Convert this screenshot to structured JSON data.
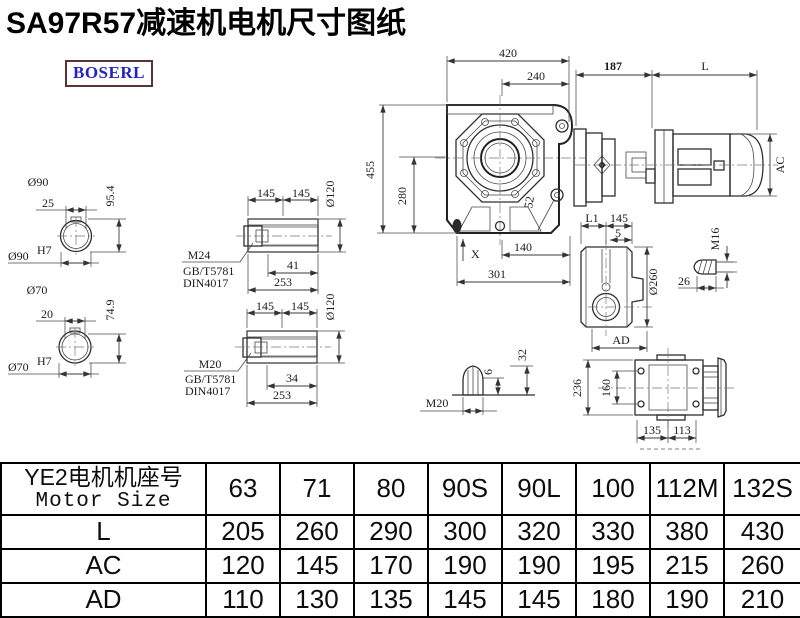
{
  "title": "SA97R57减速机电机尺寸图纸",
  "logo": {
    "text": "BOSERL"
  },
  "drawing": {
    "main_view": {
      "total_width": "420",
      "half_width": "240",
      "total_height": "455",
      "center_height": "280",
      "hole_offset": "52",
      "foot_mark": "X",
      "center_to_foot": "140",
      "base_length": "301"
    },
    "motor": {
      "flange_length": "187",
      "length": "L",
      "diameter": "AC"
    },
    "shaft_90": {
      "diameter": "Ø90",
      "keyway_width": "25",
      "height": "95.4",
      "bore": "Ø90",
      "bore_fit": "H7"
    },
    "shaft_70": {
      "diameter": "Ø70",
      "keyway_width": "20",
      "height": "74.9",
      "bore": "Ø70",
      "bore_fit": "H7"
    },
    "hollow_shaft_a": {
      "seg1": "145",
      "seg2": "145",
      "diameter": "Ø120",
      "thread_depth": "41",
      "length": "253",
      "screw": "M24",
      "standard1": "GB/T5781",
      "standard2": "DIN4017"
    },
    "hollow_shaft_b": {
      "seg1": "145",
      "seg2": "145",
      "diameter": "Ø120",
      "thread_depth": "34",
      "length": "253",
      "screw": "M20",
      "standard1": "GB/T5781",
      "standard2": "DIN4017"
    },
    "side_view": {
      "seg1": "L1",
      "seg2": "145",
      "offset": "5",
      "diameter": "Ø260",
      "width": "AD"
    },
    "bolt": {
      "thread": "M16",
      "length": "26"
    },
    "plug": {
      "thread": "M20",
      "depth": "6",
      "height": "32"
    },
    "top_view": {
      "hole_spacing": "160",
      "height": "236",
      "seg1": "135",
      "seg2": "113"
    }
  },
  "table": {
    "header_line1": "YE2电机机座号",
    "header_line2": "Motor Size",
    "columns": [
      "63",
      "71",
      "80",
      "90S",
      "90L",
      "100",
      "112M",
      "132S"
    ],
    "rows": [
      {
        "label": "L",
        "values": [
          "205",
          "260",
          "290",
          "300",
          "320",
          "330",
          "380",
          "430"
        ]
      },
      {
        "label": "AC",
        "values": [
          "120",
          "145",
          "170",
          "190",
          "190",
          "195",
          "215",
          "260"
        ]
      },
      {
        "label": "AD",
        "values": [
          "110",
          "130",
          "135",
          "145",
          "145",
          "180",
          "190",
          "210"
        ]
      }
    ]
  }
}
